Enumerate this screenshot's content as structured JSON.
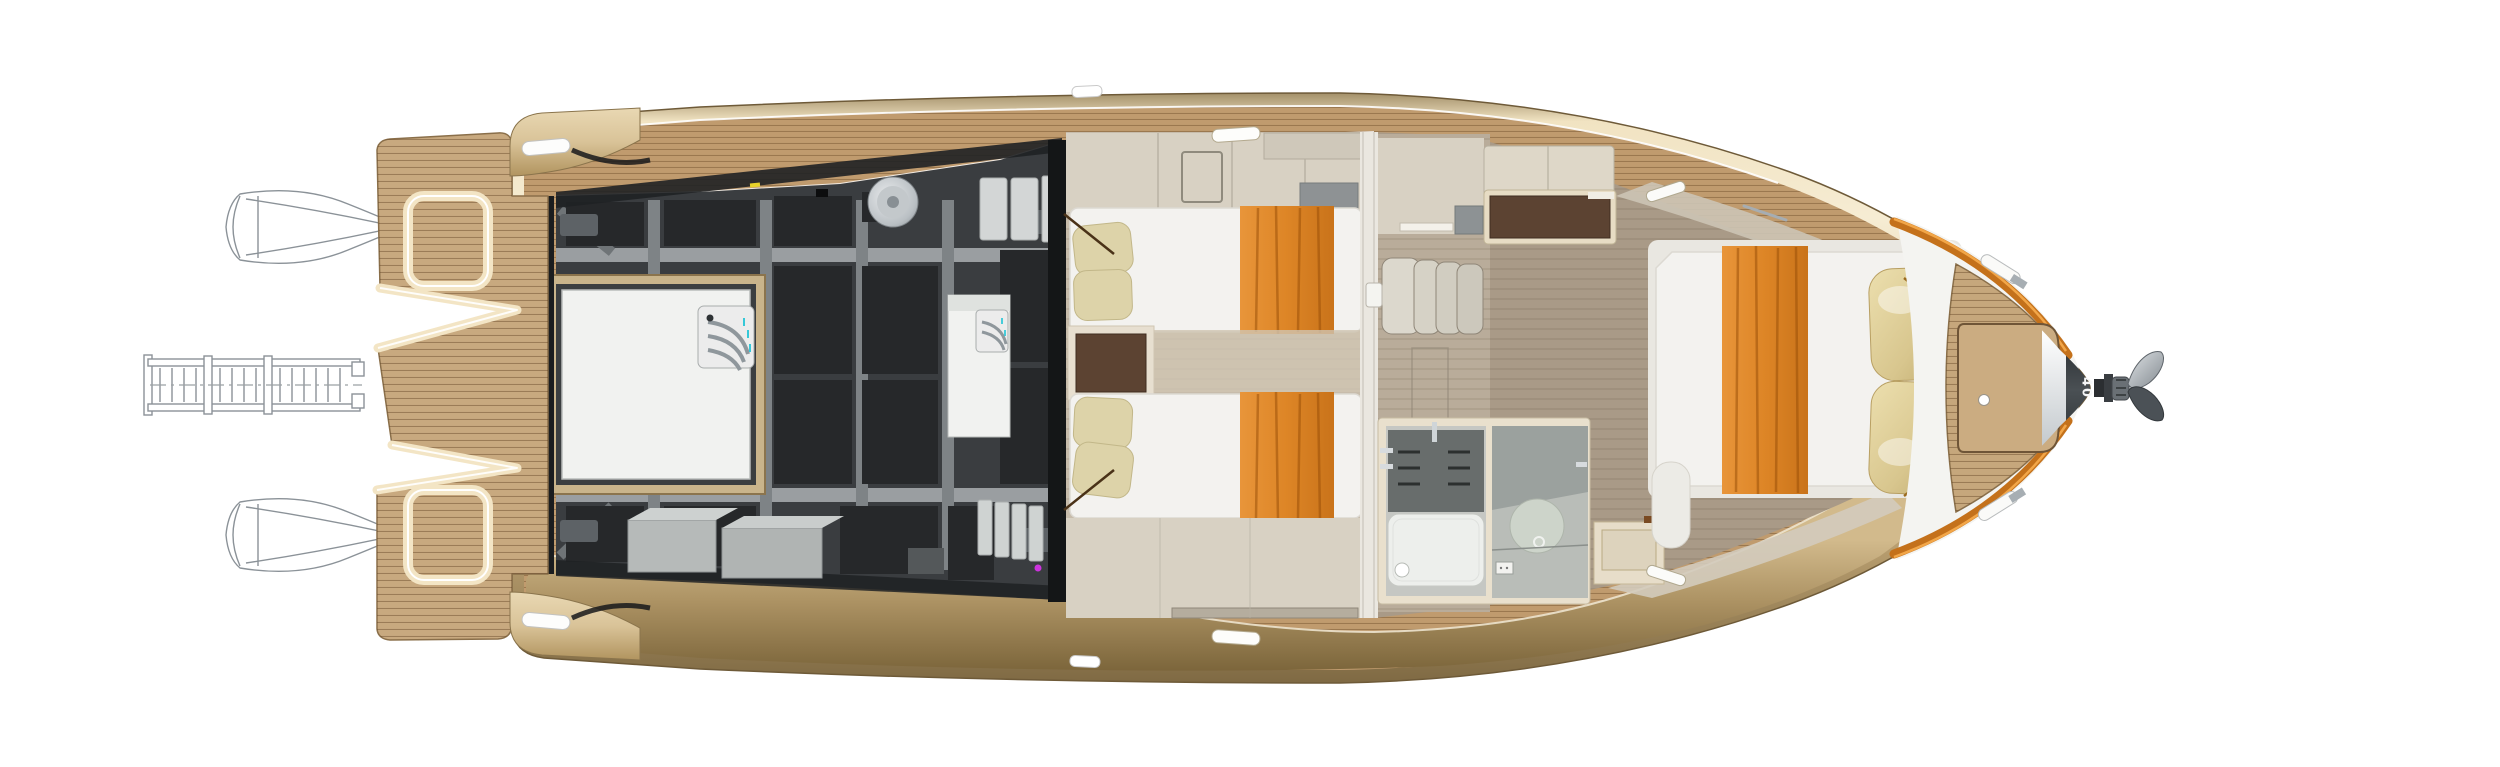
{
  "bow": {
    "hull_marking": "40"
  },
  "stern": {
    "outboard_engines_shown": 2,
    "passerelle_shown": true,
    "platform_hatches": 2
  },
  "colors": {
    "hull-outline": "#6e5a38",
    "hull-gold-light": "#f6ecd3",
    "hull-gold-mid": "#e2cda0",
    "hull-gold-dark": "#8a744a",
    "deck-wood": "#c09b6e",
    "deck-plank-line": "#8a6b45",
    "teak-platform": "#c8a97f",
    "coaming-cream": "#f3e5c5",
    "engine-dark": "#3a3d40",
    "engine-foam": "#26282a",
    "engine-frame": "#7e8386",
    "hatch-white": "#f1f2f0",
    "hatch-frame-tan": "#c9b48b",
    "mattress-white": "#f3f2ef",
    "runner-orange": "#dd8828",
    "pillow-cream": "#ddd3a9",
    "pillow-gold": "#d8c68e",
    "floor-taupe": "#a99a87",
    "wall-greige": "#d8d1c3",
    "cabinet-brown": "#5c4332",
    "shower-slat": "#686d6c",
    "toe-rail-orange": "#c4711b",
    "steel": "#9aa1a6",
    "bow-band-dark": "#3c4043",
    "line-art": "#8b9298",
    "marking-white": "#f5f6f7"
  }
}
